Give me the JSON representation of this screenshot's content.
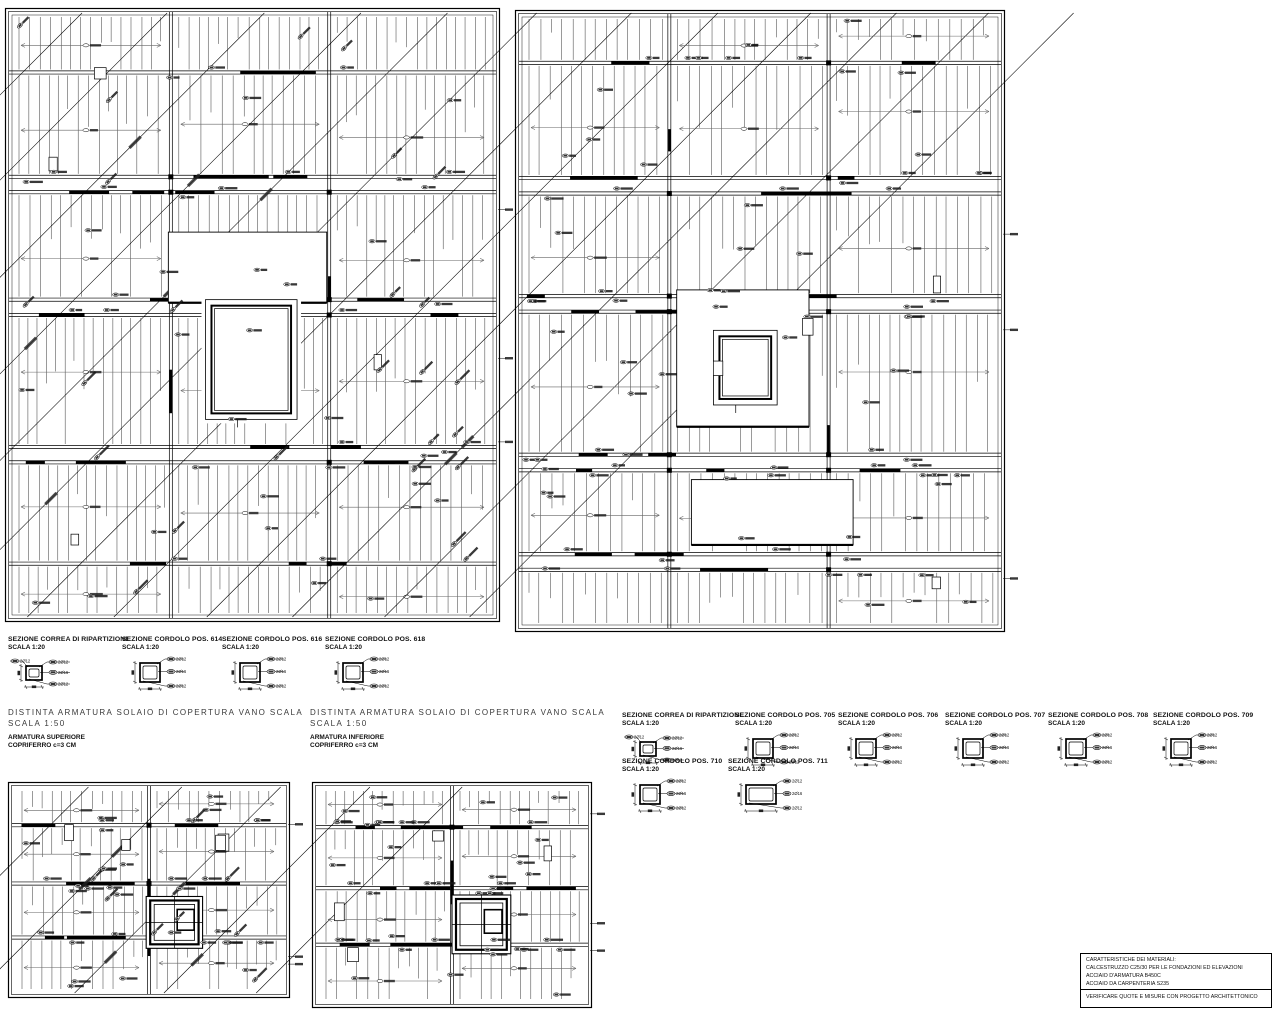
{
  "drawing": {
    "sections_left": [
      {
        "title": "SEZIONE CORREA DI RIPARTIZIONE",
        "scale": "SCALA 1:20",
        "variant": "correa"
      },
      {
        "title": "SEZIONE CORDOLO POS. 614",
        "scale": "SCALA 1:20",
        "variant": "cordolo"
      },
      {
        "title": "SEZIONE CORDOLO POS. 616",
        "scale": "SCALA 1:20",
        "variant": "cordolo"
      },
      {
        "title": "SEZIONE CORDOLO POS. 618",
        "scale": "SCALA 1:20",
        "variant": "cordolo"
      }
    ],
    "sections_right_row1": [
      {
        "title": "SEZIONE CORREA DI RIPARTIZIONE",
        "scale": "SCALA 1:20",
        "variant": "correa"
      },
      {
        "title": "SEZIONE CORDOLO POS. 705",
        "scale": "SCALA 1:20",
        "variant": "cordolo"
      },
      {
        "title": "SEZIONE CORDOLO POS. 706",
        "scale": "SCALA 1:20",
        "variant": "cordolo"
      },
      {
        "title": "SEZIONE CORDOLO POS. 707",
        "scale": "SCALA 1:20",
        "variant": "cordolo"
      },
      {
        "title": "SEZIONE CORDOLO POS. 708",
        "scale": "SCALA 1:20",
        "variant": "cordolo"
      },
      {
        "title": "SEZIONE CORDOLO POS. 709",
        "scale": "SCALA 1:20",
        "variant": "cordolo"
      }
    ],
    "sections_right_row2": [
      {
        "title": "SEZIONE CORDOLO POS. 710",
        "scale": "SCALA 1:20",
        "variant": "cordolo"
      },
      {
        "title": "SEZIONE CORDOLO POS. 711",
        "scale": "SCALA 1:20",
        "variant": "wide"
      }
    ],
    "captions": [
      {
        "line1": "DISTINTA ARMATURA SOLAIO DI COPERTURA VANO SCALA",
        "line2": "SCALA 1:50",
        "sub1": "ARMATURA SUPERIORE",
        "sub2": "COPRIFERRO c=3 CM"
      },
      {
        "line1": "DISTINTA ARMATURA SOLAIO DI COPERTURA VANO SCALA",
        "line2": "SCALA 1:50",
        "sub1": "ARMATURA INFERIORE",
        "sub2": "COPRIFERRO c=3 CM"
      }
    ],
    "section_callouts": [
      "2Ø12",
      "2Ø16",
      "2Ø12"
    ],
    "materials_box": {
      "lines": [
        "CARATTERISTICHE DEI MATERIALI:",
        "CALCESTRUZZO C25/30 PER  LE FONDAZIONI ED ELEVAZIONI",
        "ACCIAIO D'ARMATURA B450C",
        "ACCIAIO DA CARPENTERIA S235"
      ],
      "note": "VERIFICARE QUOTE E MISURE CON PROGETTO ARCHITETTONICO"
    },
    "line_color": "#000000",
    "dim_color": "#666666"
  }
}
